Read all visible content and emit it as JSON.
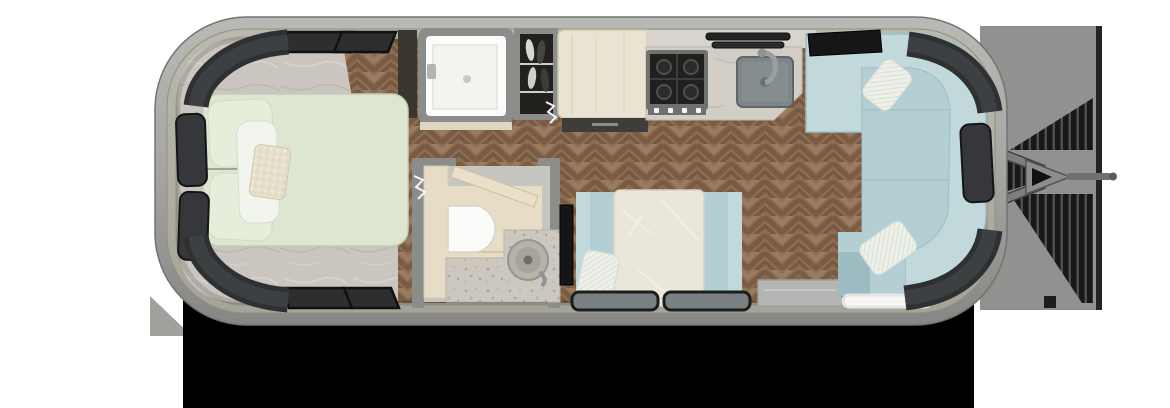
{
  "colors": {
    "page_bg": "#ffffff",
    "shadow": "#000000",
    "wall_band": "#b2b0a3",
    "marble_floor": "#cac5be",
    "bed": "#dce6d0",
    "bed_pillow_sage": "#e6eedb",
    "pillow_white": "#f2f4ee",
    "pillow_accent": "#e6dfca",
    "headboard_cabinet": "#3a352f",
    "window_glass": "#35373a",
    "window_frame": "#141516",
    "room_wall": "#8b8d8a",
    "shower_white": "#fbfbf9",
    "closet_interior": "#23211e",
    "fridge_body": "#ebe3d2",
    "fridge_base": "#3e3d39",
    "counter_marble": "#d2cdc5",
    "cooktop_frame": "#6e716d",
    "cooktop_surface": "#1f211f",
    "knob_white": "#f5f5f2",
    "sink_rim": "#7f8689",
    "sink_basin": "#868d90",
    "tv_black": "#151617",
    "sofa_back": "#c2d9dc",
    "sofa_seat": "#b3cfd4",
    "sofa_corner": "#9dbcc2",
    "dinette_table": "#ebe6da",
    "bench_seat": "#b3cfd4",
    "bench_back": "#c2d9dc",
    "bath_wood": "#e7ddc6",
    "toilet_white": "#fbfbf9",
    "terrazzo": "#ccc8bf",
    "vessel_sink": "#a7a49c",
    "entry_step": "#b4b6b3",
    "led_strip": "#ffffff",
    "door_panel": "#eadfc7",
    "hitch_platform": "#90928f",
    "hitch_metal": "#8b8e8b",
    "dinette_window_glass": "#788082"
  }
}
